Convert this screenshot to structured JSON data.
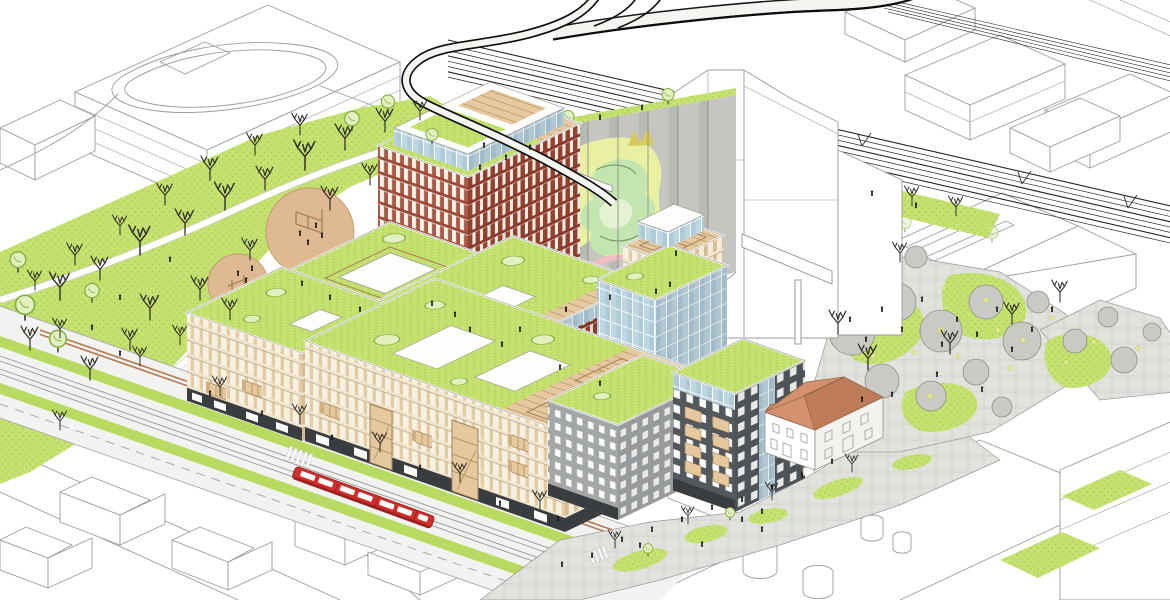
{
  "meta": {
    "title": "Bird's-eye axonometric masterplan illustration of a mixed-use urban redevelopment beside a railway corridor",
    "medium": "architectural line drawing with selective colour",
    "view": "aerial axonometric from the south-west",
    "canvas_width": 1170,
    "canvas_height": 600
  },
  "scene": {
    "background": "white paper, surrounding city fabric drawn as uncoloured grey linework",
    "landmarks": [
      {
        "id": "railway-corridor",
        "label": "Railway corridor",
        "notes": "band of parallel tracks with catenary masts crossing the top of the image"
      },
      {
        "id": "flyover-loop",
        "label": "Looping flyover track",
        "notes": "black ribbon that sweeps in from the top edge, makes a U-turn and descends into the site"
      },
      {
        "id": "grain-silo",
        "label": "Concrete silo with graffiti mural",
        "notes": "fluted grey silo wall painted with a large yellow-green and pink mural, green roof on top"
      },
      {
        "id": "silo-headhouse",
        "label": "Silo head-house",
        "notes": "tall white industrial volume behind the silo, drawn as outline"
      },
      {
        "id": "conveyor-gallery",
        "label": "Elevated conveyor gallery",
        "notes": "white bridge on a single column reaching over the event plaza"
      },
      {
        "id": "brick-tower",
        "label": "Red-brick tower",
        "notes": "tallest new building, glazed penthouse and green roof terrace"
      },
      {
        "id": "brick-midrise",
        "label": "Red-brick mid-rise block",
        "notes": "clerestory glass band below a planted roof"
      },
      {
        "id": "cream-street-blocks",
        "label": "Cream perimeter blocks",
        "notes": "two long blocks along the tram boulevard with timber balconies and stair towers"
      },
      {
        "id": "courtyard-block",
        "label": "Courtyard-roof block",
        "notes": "green roof with a white-framed courtyard opening"
      },
      {
        "id": "glass-tower",
        "label": "Blue glass tower",
        "notes": "curtain-wall tower with planted roof"
      },
      {
        "id": "rooftop-pavilion",
        "label": "Rooftop timber pavilion",
        "notes": "small tan tower with a wooden pergola deck"
      },
      {
        "id": "grey-block",
        "label": "Grey residential block",
        "notes": "punched-window facade, green roof"
      },
      {
        "id": "timber-balcony-block",
        "label": "Dark block with timber balconies",
        "notes": "stacked wooden balcony boxes on a dark facade"
      },
      {
        "id": "heritage-house",
        "label": "Heritage house",
        "notes": "white historic building with terracotta hip roof kept inside the new quarter"
      },
      {
        "id": "park",
        "label": "Neighbourhood park",
        "notes": "lawn with bare winter trees, curving white paths and two sandy play circles"
      },
      {
        "id": "tram-boulevard",
        "label": "Tram boulevard",
        "notes": "grassed tram tracks, cycle lane, zebra crossings and street trees"
      },
      {
        "id": "red-tram",
        "label": "Red tram",
        "notes": "single articulated light-rail vehicle running south-east"
      },
      {
        "id": "pedestrian-street",
        "label": "Paved pedestrian street",
        "notes": "curved paved street with organic planting islands between new and old buildings"
      },
      {
        "id": "event-plaza",
        "label": "Event plaza",
        "notes": "field of round grey canopies / planters with yellow café tables and many people"
      },
      {
        "id": "context-fabric",
        "label": "Context city fabric",
        "notes": "surrounding houses, halls, tanks and slab buildings drawn as white outline volumes"
      }
    ],
    "counts": {
      "play_circles": 2,
      "plaza_canopy_circles": 16,
      "tram_vehicles": 1,
      "bare_trees_approx": 50,
      "green_roof_buildings": 9
    }
  },
  "palette": {
    "paper": "#ffffff",
    "linework": "#9b9b9b",
    "lawn": "#c5e170",
    "lawn-dot": "#a9cc52",
    "grass": "#b9da60",
    "tree-stroke": "#85b243",
    "tree-fill": "#e2efbe",
    "bare-tree": "#33302a",
    "sand": "#dfb992",
    "sand-edge": "#bf9a6e",
    "pave": "#e1e1dd",
    "pave-line": "#cdcdc7",
    "plaza-circle": "#c9c9c5",
    "plaza-circle-edge": "#8f8f8a",
    "table-dot": "#e6eb8e",
    "road": "#f2f2f0",
    "road-line": "#a8a8a4",
    "bike": "#b57851",
    "cream-bg": "#f7f1e4",
    "cream-pier": "#e5cba3",
    "cream-band": "#f0e5d0",
    "cream-line": "#b59a72",
    "creamR-bg": "#f2eadb",
    "creamR-pier": "#d8bc8f",
    "brick-win": "#f6f2ec",
    "brick-pier": "#ac5a46",
    "brick-band": "#a04c3a",
    "brickR-win": "#f0ebe3",
    "brickR-pier": "#93402f",
    "brickR-band": "#893a2b",
    "glass": "#accad8",
    "glass-pane": "#bdd6e1",
    "dark-facade": "#53585c",
    "dark-base": "#3a3d40",
    "grey-facade": "#a3a7a8",
    "window": "#fbfbf9",
    "wood": "#e5c89d",
    "wood-dark": "#cfae7f",
    "wood-line": "#a8845a",
    "silo": "#c5c6c1",
    "silo-shade": "#aaaca6",
    "mural-yellow": "#e9f0a2",
    "mural-green": "#c3e5b0",
    "mural-pink": "#f3bcc3",
    "mural-gold": "#d8c860",
    "roof-orange": "#d39170",
    "roof-orange-dark": "#bd7b57",
    "tram-red": "#d02e2a",
    "tram-dark": "#9e1f1e",
    "person": "#161616"
  }
}
